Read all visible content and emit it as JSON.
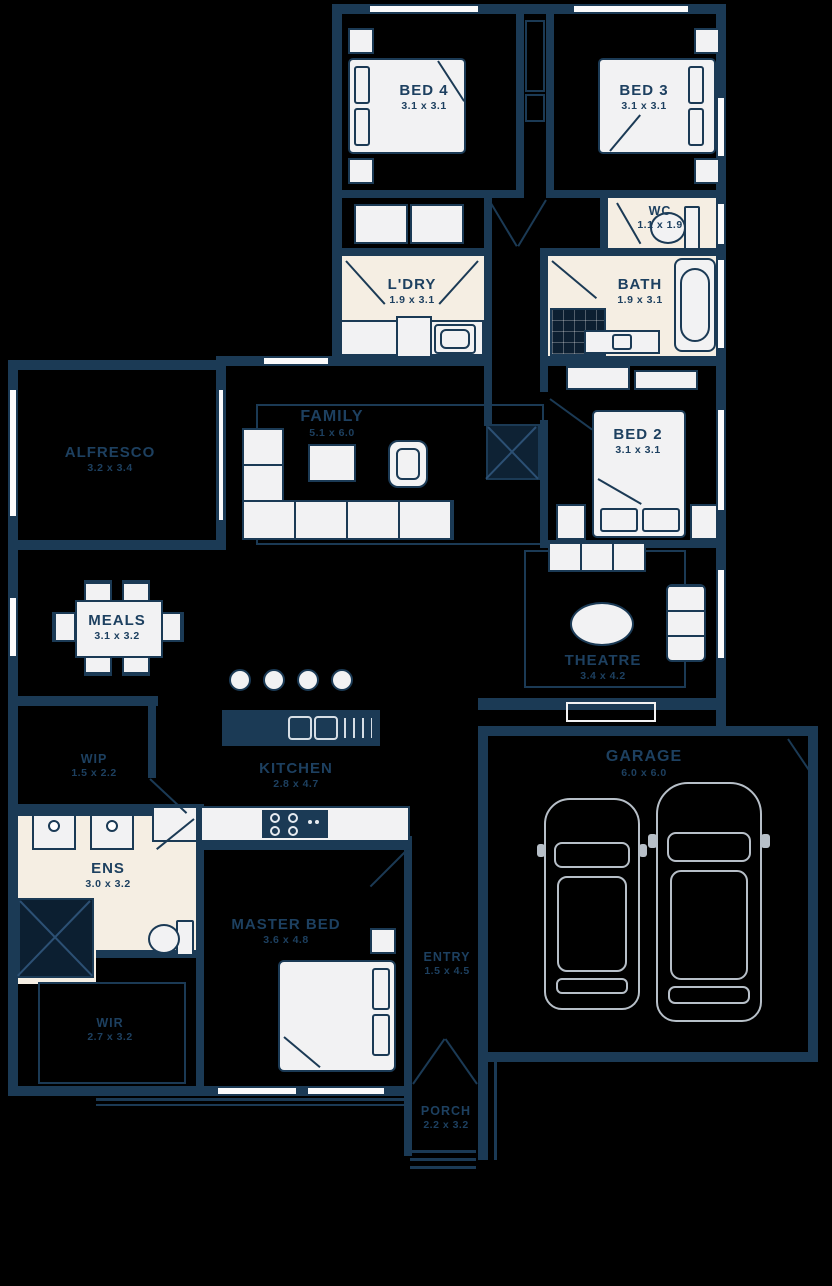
{
  "plan_type": "residential-floor-plan",
  "rooms": {
    "bed4": {
      "name": "BED 4",
      "dims": "3.1 x 3.1"
    },
    "bed3": {
      "name": "BED 3",
      "dims": "3.1 x 3.1"
    },
    "wc": {
      "name": "WC",
      "dims": "1.1 x 1.9"
    },
    "ldry": {
      "name": "L'DRY",
      "dims": "1.9 x 3.1"
    },
    "bath": {
      "name": "BATH",
      "dims": "1.9 x 3.1"
    },
    "alfresco": {
      "name": "ALFRESCO",
      "dims": "3.2 x 3.4"
    },
    "family": {
      "name": "FAMILY",
      "dims": "5.1 x 6.0"
    },
    "bed2": {
      "name": "BED 2",
      "dims": "3.1 x 3.1"
    },
    "meals": {
      "name": "MEALS",
      "dims": "3.1 x 3.2"
    },
    "theatre": {
      "name": "THEATRE",
      "dims": "3.4 x 4.2"
    },
    "wip": {
      "name": "WIP",
      "dims": "1.5 x 2.2"
    },
    "kitchen": {
      "name": "KITCHEN",
      "dims": "2.8 x 4.7"
    },
    "ens": {
      "name": "ENS",
      "dims": "3.0 x 3.2"
    },
    "master": {
      "name": "MASTER BED",
      "dims": "3.6 x 4.8"
    },
    "entry": {
      "name": "ENTRY",
      "dims": "1.5 x 4.5"
    },
    "wir": {
      "name": "WIR",
      "dims": "2.7 x 3.2"
    },
    "garage": {
      "name": "GARAGE",
      "dims": "6.0 x 6.0"
    },
    "porch": {
      "name": "PORCH",
      "dims": "2.2 x 3.2"
    }
  },
  "colors": {
    "background": "#000000",
    "wall": "#1b3a55",
    "wet_floor": "#f5eee3",
    "furniture_fill": "#f2f2f3",
    "label_text": "#1d4060",
    "car_outline": "#c7d0d9"
  }
}
